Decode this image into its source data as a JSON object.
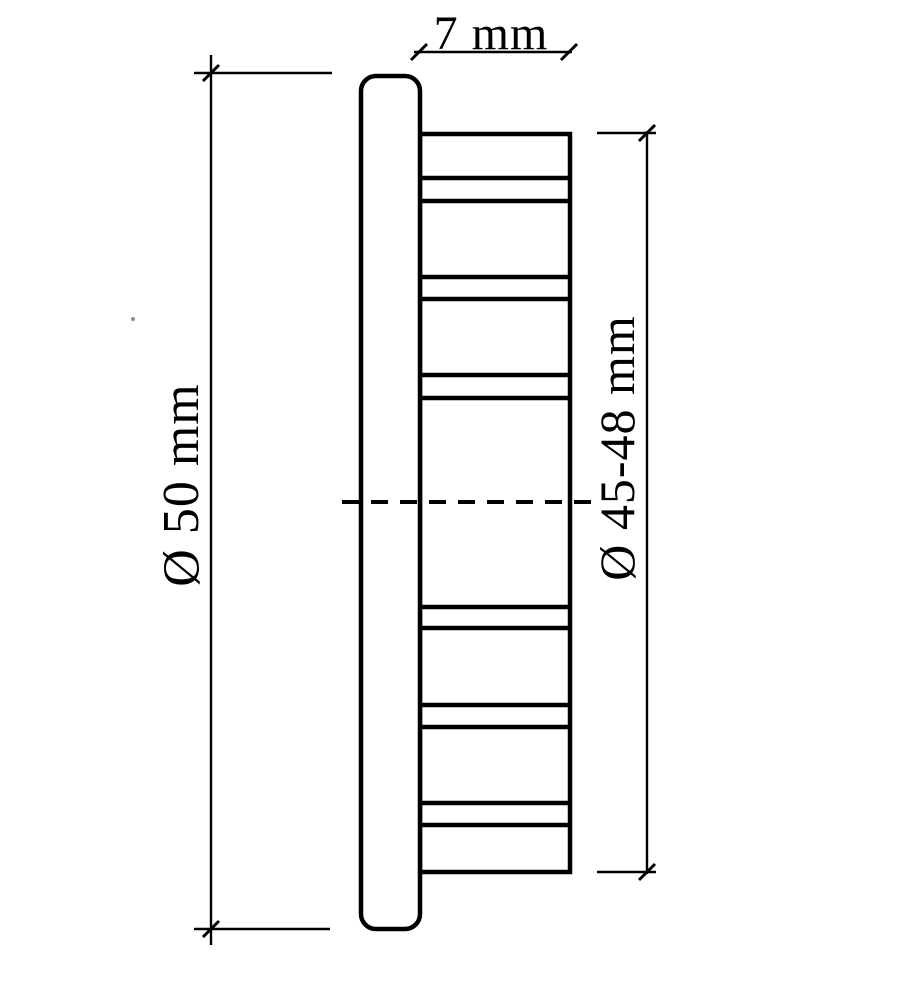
{
  "colors": {
    "line": "#000000",
    "background": "#ffffff"
  },
  "labels": {
    "flange_width": "7 mm",
    "outer_diameter": "Ø 50 mm",
    "insert_diameter": "Ø 45-48 mm"
  }
}
